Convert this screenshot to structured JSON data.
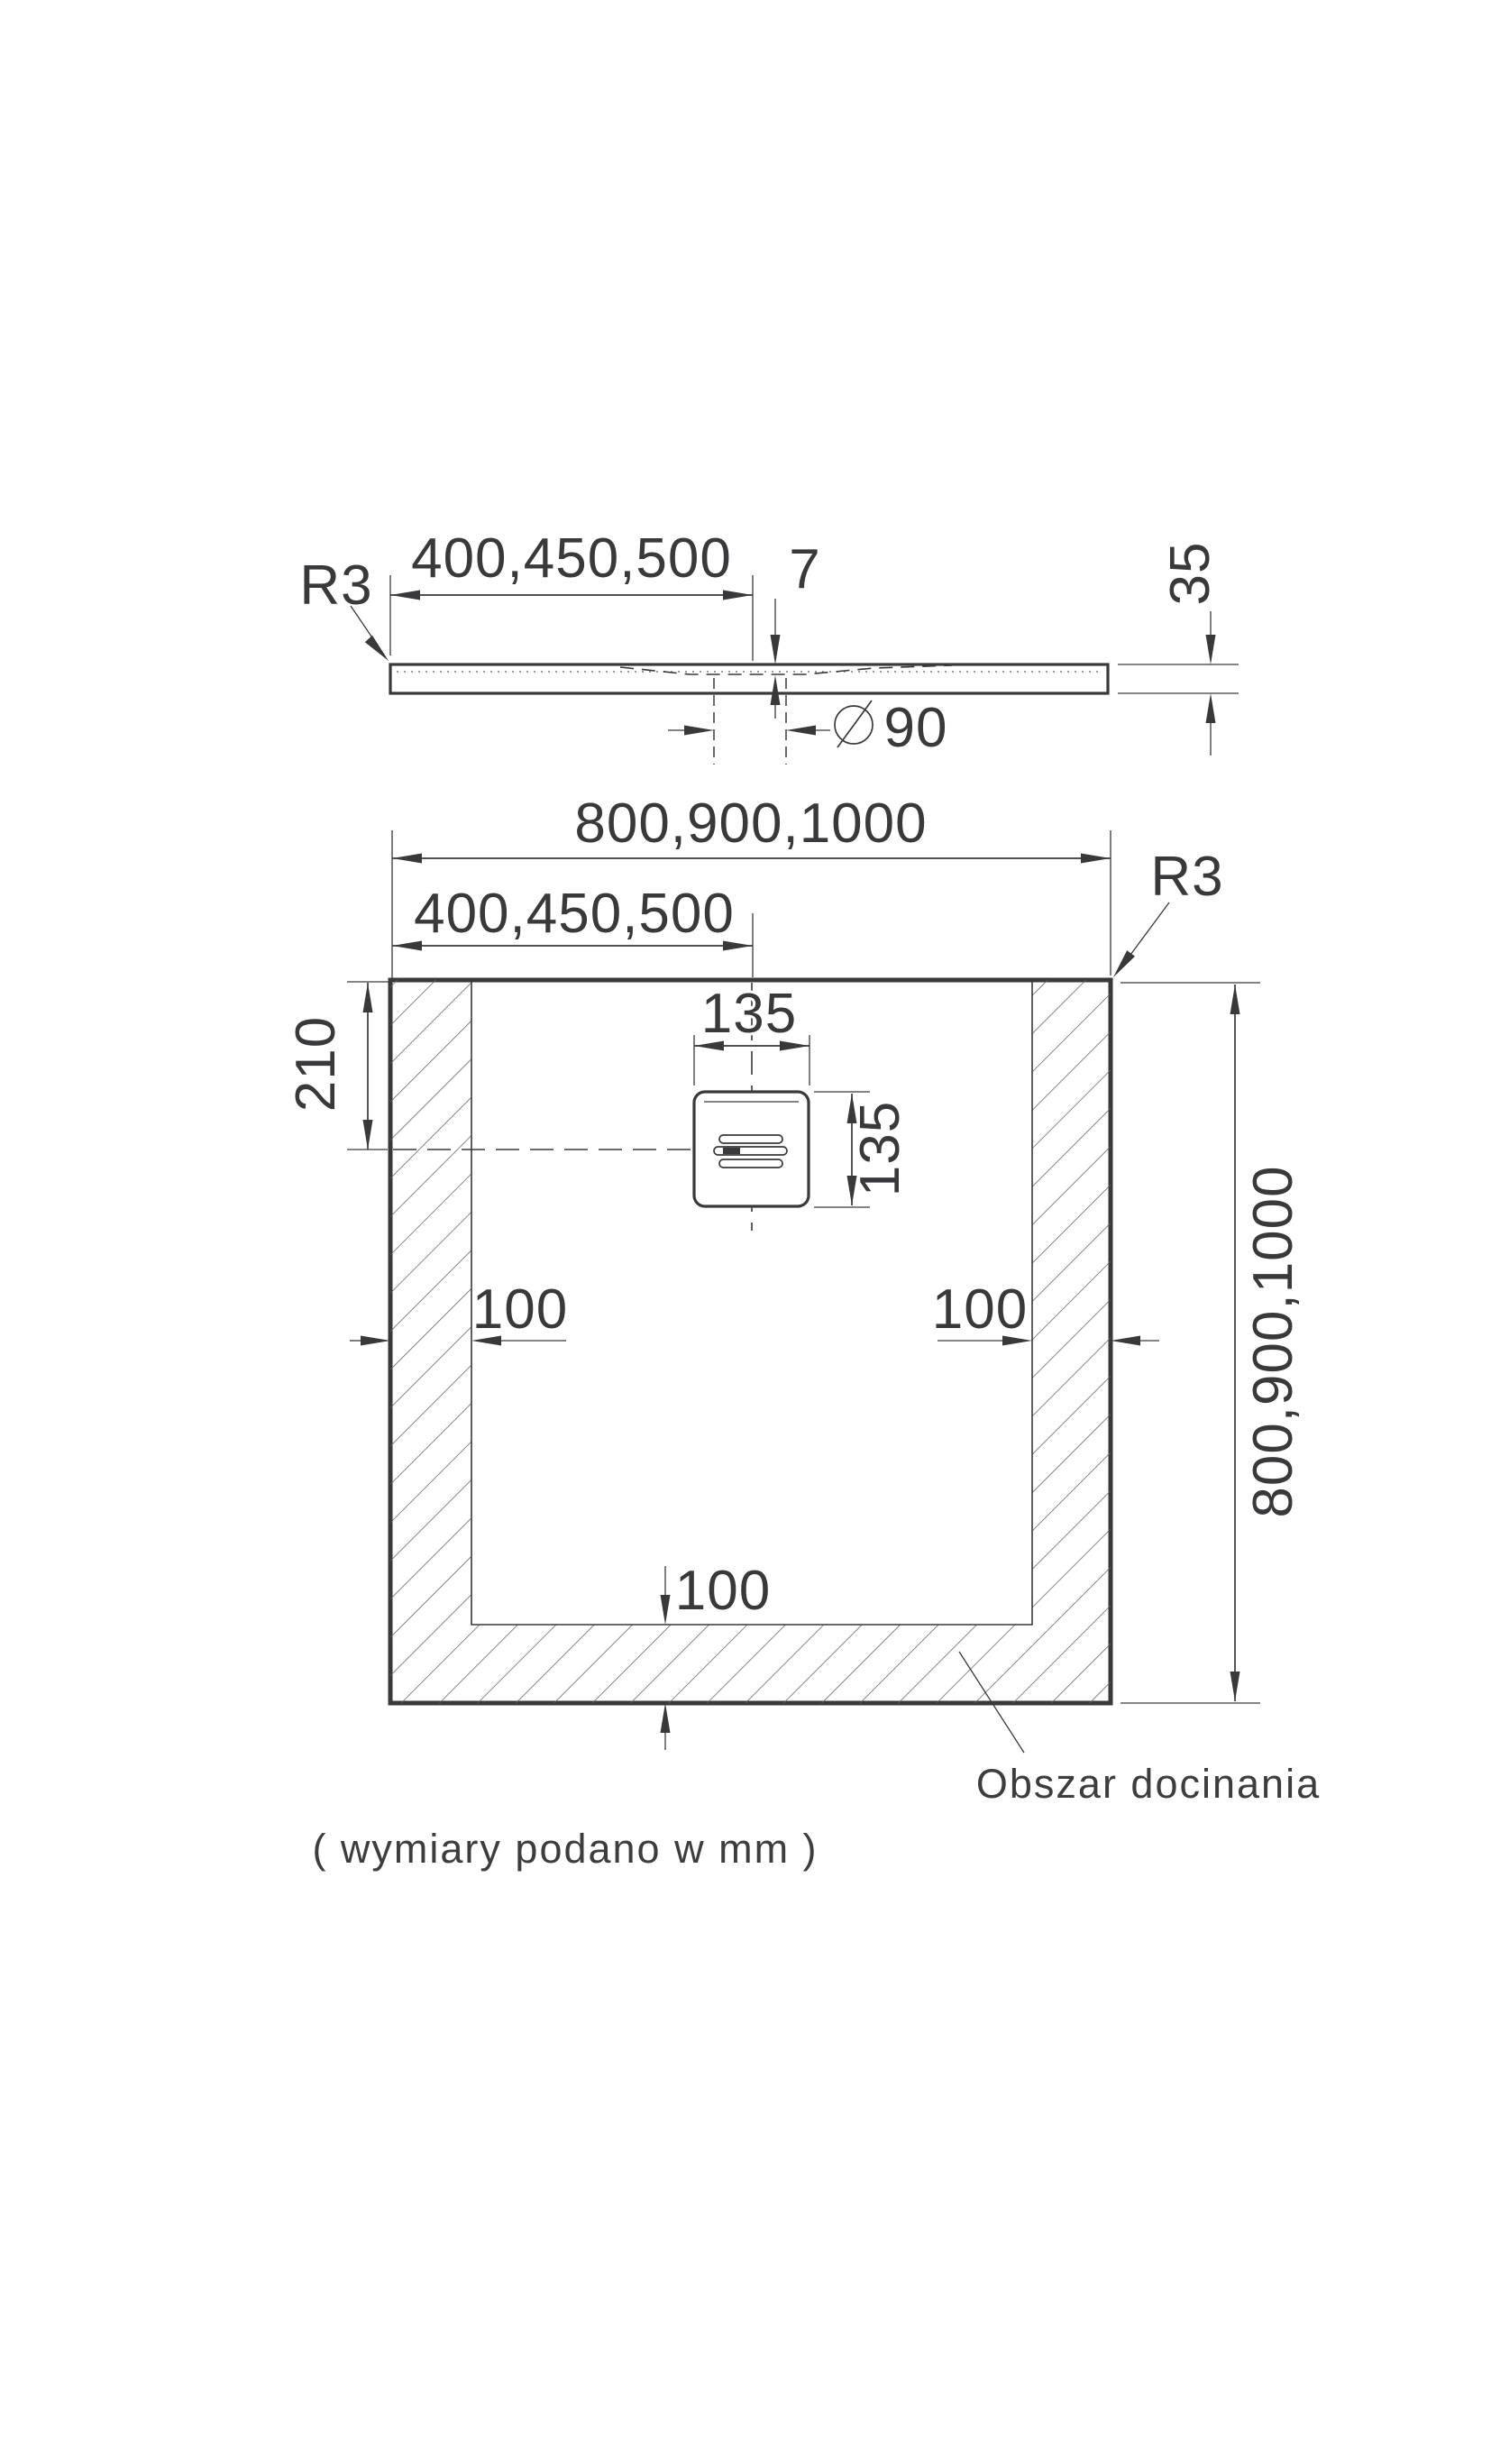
{
  "page": {
    "background": "#ffffff",
    "ink_color": "#39393b"
  },
  "profile_view": {
    "radius_label": "R3",
    "drain_offset_dim": "400,450,500",
    "recess_depth_dim": "7",
    "tray_height_dim": "35",
    "drain_diameter_symbol": "diameter-symbol",
    "drain_diameter_dim": "90"
  },
  "plan_view": {
    "overall_width_dim": "800,900,1000",
    "drain_offset_x_dim": "400,450,500",
    "radius_label": "R3",
    "drain_offset_y_dim": "210",
    "drain_width_dim": "135",
    "drain_height_dim": "135",
    "trim_left_dim": "100",
    "trim_right_dim": "100",
    "trim_bottom_dim": "100",
    "overall_depth_dim": "800,900,1000",
    "trim_area_label": "Obszar docinania"
  },
  "footnote": "( wymiary podano w mm )"
}
